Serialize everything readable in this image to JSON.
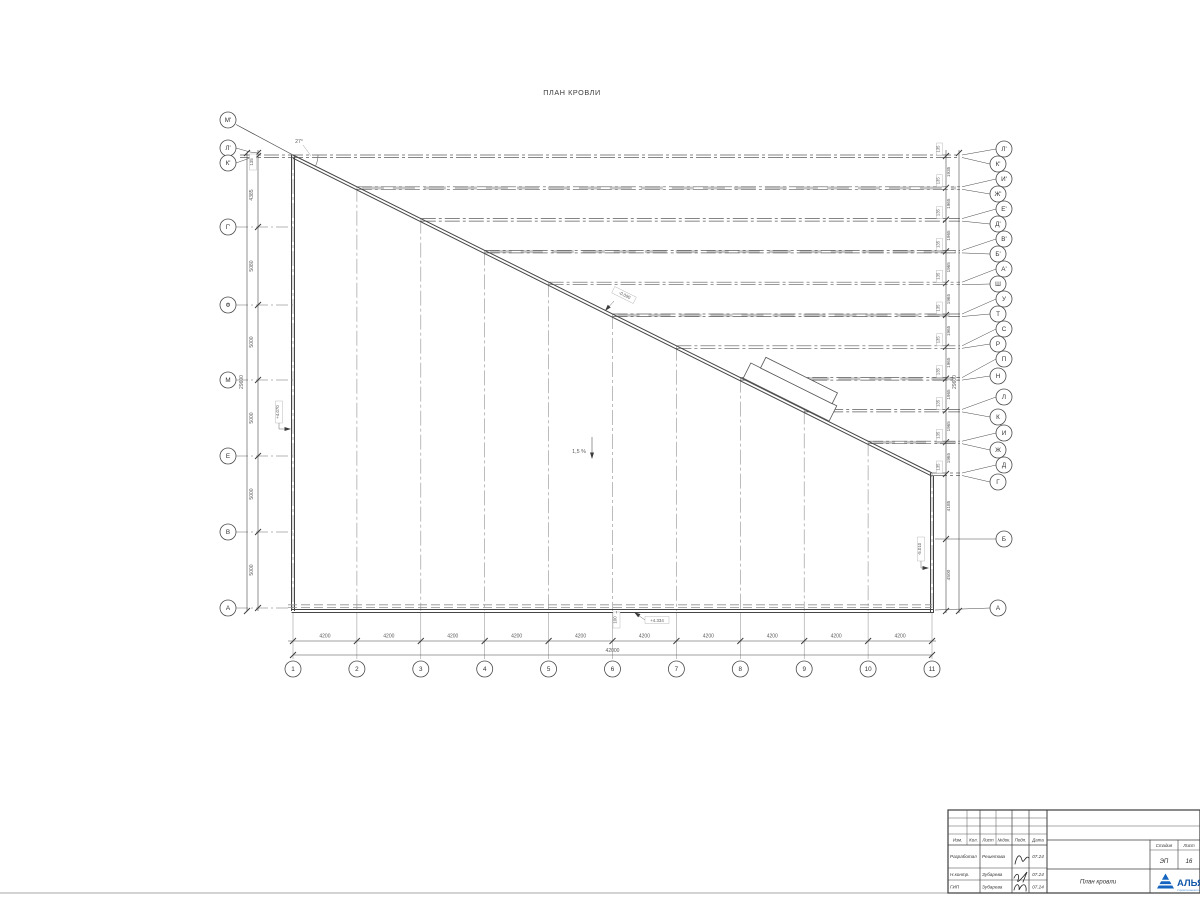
{
  "drawing": {
    "title": "ПЛАН КРОВЛИ",
    "angle_label": "27°",
    "slope_label": "1,5 %",
    "edge_dim": "100",
    "left_axes": [
      {
        "label": "М'",
        "y": 120
      },
      {
        "label": "Л'",
        "y": 148
      },
      {
        "label": "К'",
        "y": 163
      },
      {
        "label": "Г'",
        "y": 227
      },
      {
        "label": "Ф",
        "y": 305
      },
      {
        "label": "М",
        "y": 380
      },
      {
        "label": "Е",
        "y": 456
      },
      {
        "label": "В",
        "y": 532
      },
      {
        "label": "А",
        "y": 608
      }
    ],
    "left_dims": [
      {
        "text": "135",
        "y": 162,
        "boxed": true
      },
      {
        "text": "4385",
        "y": 195
      },
      {
        "text": "5080",
        "y": 266
      },
      {
        "text": "5000",
        "y": 342
      },
      {
        "text": "5000",
        "y": 418
      },
      {
        "text": "5000",
        "y": 494
      },
      {
        "text": "5000",
        "y": 570
      }
    ],
    "left_total": "29600",
    "right_axes_labels": [
      "Л'",
      "К'",
      "И'",
      "Ж'",
      "Е'",
      "Д'",
      "В'",
      "Б'",
      "А'",
      "Ш",
      "У",
      "Т",
      "С",
      "Р",
      "П",
      "Н",
      "Л",
      "К",
      "И",
      "Ж",
      "Д",
      "Г",
      "Б",
      "А"
    ],
    "right_axes_y": [
      149,
      164,
      179,
      194,
      209,
      224,
      239,
      254,
      269,
      284,
      299,
      314,
      329,
      344,
      359,
      376,
      397,
      417,
      433,
      450,
      465,
      482,
      539,
      608
    ],
    "right_pair_dim": "135",
    "right_gap_dims": [
      "1935",
      "1965",
      "1965",
      "1965",
      "1965",
      "1965",
      "1965",
      "1965",
      "1965",
      "1965"
    ],
    "right_lower_dims": [
      {
        "text": "4185",
        "y": 506
      },
      {
        "text": "4500",
        "y": 575
      }
    ],
    "right_total": "29600",
    "bottom_axes": [
      "1",
      "2",
      "3",
      "4",
      "5",
      "6",
      "7",
      "8",
      "9",
      "10",
      "11"
    ],
    "bottom_dims": [
      "4200",
      "4200",
      "4200",
      "4200",
      "4200",
      "4200",
      "4200",
      "4200",
      "4200",
      "4200"
    ],
    "bottom_total": "42000",
    "elevations": {
      "left": "+4.070",
      "diagonal": "-0.090",
      "bottom": "+4.334",
      "right": "-5.010"
    }
  },
  "titleblock": {
    "header_cols": [
      "Изм.",
      "Кол.",
      "Лист",
      "№док.",
      "Подп.",
      "Дата"
    ],
    "rows": [
      {
        "role": "Разработал",
        "name": "Решетова",
        "date": "07.24"
      },
      {
        "role": "Н.контр.",
        "name": "Зубарева",
        "date": "07.24"
      },
      {
        "role": "ГИП",
        "name": "Зубарева",
        "date": "07.24"
      }
    ],
    "doc_title": "План кровли",
    "stage_label": "Стадия",
    "sheet_label": "Лист",
    "stage_value": "ЭП",
    "sheet_value": "16",
    "logo_text": "АЛЬЯН",
    "logo_subtext": "строительная компания",
    "logo_color": "#1565c0"
  }
}
